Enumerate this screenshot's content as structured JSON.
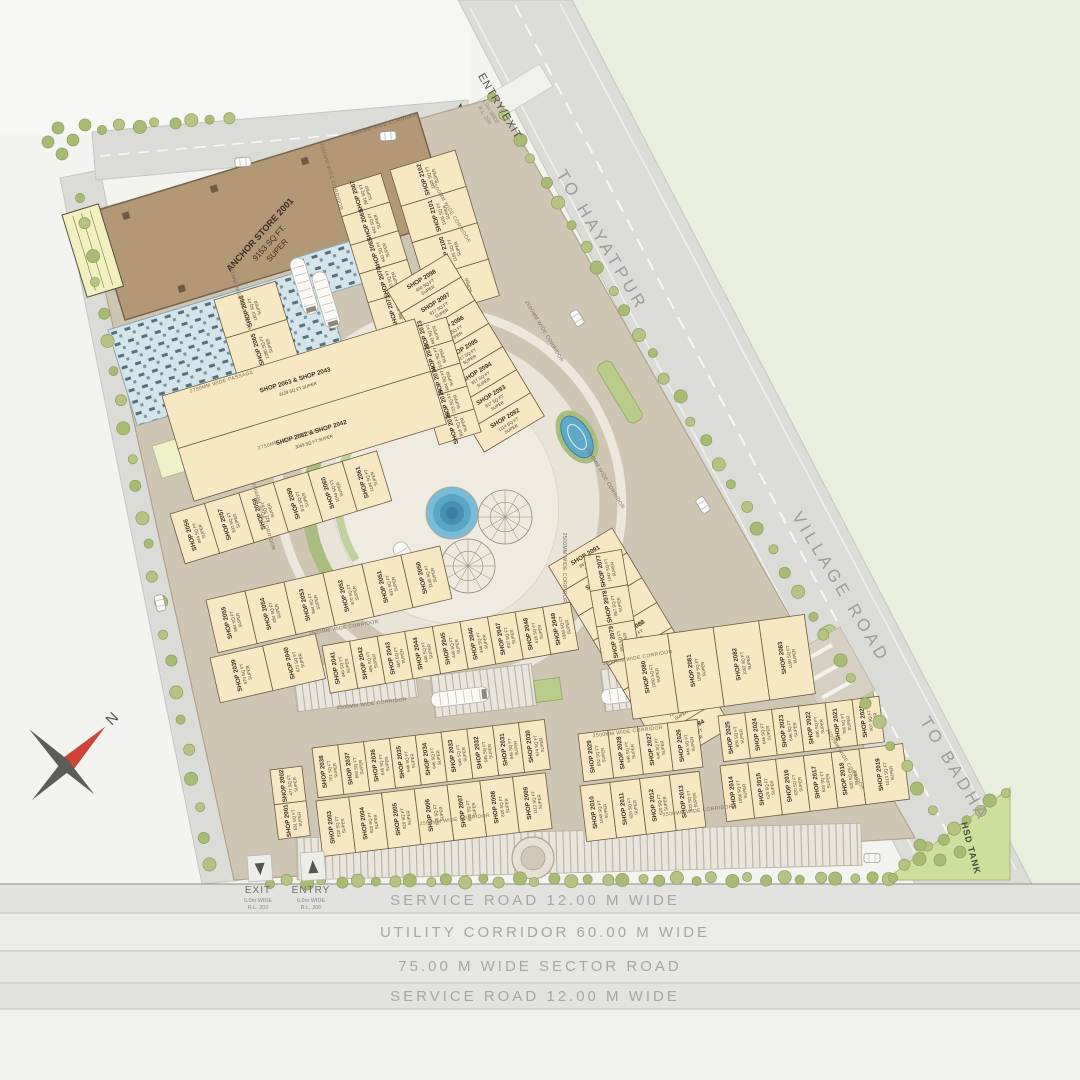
{
  "plan": {
    "compass_label": "N",
    "roads": {
      "to_hayatpur": "TO HAYATPUR",
      "village_road": "VILLAGE ROAD",
      "to_badha": "TO BADHA"
    },
    "bands": {
      "service_top": "SERVICE ROAD 12.00 M WIDE",
      "utility": "UTILITY CORRIDOR 60.00 M WIDE",
      "sector": "75.00 M WIDE  SECTOR ROAD",
      "service_bottom": "SERVICE ROAD 12.00 M WIDE"
    },
    "gates": {
      "entry_exit": "ENTRY/EXIT",
      "exit": "EXIT",
      "entry": "ENTRY",
      "width_note": "6.0m WIDE",
      "rl_note": "R.L. 200"
    },
    "anchor": {
      "line1": "ANCHOR STORE 2001",
      "line2": "9153 SQ FT.",
      "line3": "SUPER"
    },
    "hsd_tank": "HSD TANK",
    "lift_label": "H",
    "words": {
      "shop": "SHOP",
      "sqft": "SQ FT",
      "super": "SUPER"
    },
    "corridor_label": "2500MM WIDE CORRIDOR",
    "passage_label": "2750MM WIDE PASSAGE",
    "colors": {
      "shop_fill": "#f7e7c2",
      "anchor_fill": "#b39878",
      "road_fill": "#dbdbd7",
      "site_fill": "#cfc5b3",
      "green_area": "#eaeedd",
      "water": "#5fa8c8",
      "lawn": "#b9cc8b",
      "hsd_fill": "#cede9c"
    },
    "corridor_positions": [
      [
        385,
        126,
        -17,
        "c"
      ],
      [
        330,
        177,
        73,
        "c"
      ],
      [
        450,
        213,
        59,
        "c"
      ],
      [
        543,
        332,
        59,
        "c"
      ],
      [
        238,
        297,
        73,
        "c"
      ],
      [
        222,
        383,
        -17,
        "p"
      ],
      [
        262,
        517,
        73,
        "c"
      ],
      [
        344,
        629,
        -10,
        "c"
      ],
      [
        372,
        705,
        -7,
        "c"
      ],
      [
        563,
        568,
        90,
        "c"
      ],
      [
        604,
        479,
        59,
        "c"
      ],
      [
        638,
        659,
        -10,
        "c"
      ],
      [
        628,
        733,
        -7,
        "c"
      ],
      [
        455,
        821,
        -7,
        "c"
      ],
      [
        698,
        812,
        -7,
        "c"
      ],
      [
        844,
        760,
        59,
        "c"
      ],
      [
        290,
        440,
        -17,
        "p"
      ]
    ],
    "blocks": [
      {
        "id": "col-2066",
        "x": 214,
        "y": 300,
        "r": -17,
        "dir": "col",
        "cw": 64,
        "ch": 40,
        "shops": [
          [
            "2066",
            "1657"
          ],
          [
            "2065",
            "1280"
          ],
          [
            "2064",
            "1175"
          ]
        ]
      },
      {
        "id": "col-2067",
        "x": 333,
        "y": 188,
        "r": -17,
        "dir": "col",
        "cw": 50,
        "ch": 30,
        "shops": [
          [
            "2067",
            "881"
          ],
          [
            "2068",
            "642"
          ],
          [
            "2069",
            "643"
          ],
          [
            "2070",
            "643"
          ],
          [
            "2071",
            "886"
          ]
        ]
      },
      {
        "id": "col-2102",
        "x": 390,
        "y": 170,
        "r": -17,
        "dir": "col",
        "cw": 68,
        "ch": 38,
        "shops": [
          [
            "2102",
            "1105"
          ],
          [
            "2101",
            "1105"
          ],
          [
            "2100",
            "1105"
          ],
          [
            "2099",
            "1105"
          ]
        ]
      },
      {
        "id": "strip-2098",
        "x": 447,
        "y": 254,
        "r": 59,
        "dir": "row",
        "cw": 27,
        "ch": 70,
        "shops": [
          [
            "2098",
            "450"
          ],
          [
            "2097",
            "817"
          ],
          [
            "2096",
            "817"
          ],
          [
            "2095",
            "817"
          ],
          [
            "2094",
            "817"
          ],
          [
            "2093",
            "817"
          ],
          [
            "2092",
            "1114"
          ]
        ]
      },
      {
        "id": "col-2073",
        "x": 404,
        "y": 330,
        "r": -17,
        "dir": "col",
        "cw": 44,
        "ch": 24,
        "shops": [
          [
            "2073",
            "492"
          ],
          [
            "2072",
            "575"
          ],
          [
            "2074",
            "804"
          ],
          [
            "2075",
            "723"
          ],
          [
            "2076",
            "918"
          ]
        ]
      },
      {
        "id": "big-units",
        "x": 162,
        "y": 396,
        "r": -17,
        "dir": "col",
        "cw": 264,
        "ch": 55,
        "big": true,
        "shops": [
          [
            "SHOP 2063 & SHOP 2043",
            "3129"
          ],
          [
            "SHOP 2062 & SHOP 2042",
            "3049"
          ]
        ]
      },
      {
        "id": "row-2056",
        "x": 170,
        "y": 514,
        "r": -17,
        "dir": "row",
        "cw": 36,
        "ch": 52,
        "shops": [
          [
            "2056",
            "844"
          ],
          [
            "2057",
            "832"
          ],
          [
            "2058",
            "821"
          ],
          [
            "2059",
            "872"
          ],
          [
            "2060",
            "1044"
          ],
          [
            "2061",
            "1184"
          ]
        ]
      },
      {
        "id": "row-2055",
        "x": 206,
        "y": 600,
        "r": -13,
        "dir": "row",
        "cw": 40,
        "ch": 54,
        "shops": [
          [
            "2055",
            "864"
          ],
          [
            "2054",
            "854"
          ],
          [
            "2053",
            "844"
          ],
          [
            "2052",
            "870"
          ],
          [
            "2051",
            "831"
          ],
          [
            "2050",
            "1108"
          ]
        ]
      },
      {
        "id": "row-2039",
        "x": 210,
        "y": 658,
        "r": -13,
        "dir": "row",
        "cw": 54,
        "ch": 46,
        "shops": [
          [
            "2039",
            "970"
          ],
          [
            "2040",
            "870"
          ]
        ]
      },
      {
        "id": "row-2041",
        "x": 322,
        "y": 646,
        "r": -10,
        "dir": "row",
        "cw": 28,
        "ch": 48,
        "shops": [
          [
            "2041",
            "440"
          ],
          [
            "2042",
            "465"
          ],
          [
            "2043",
            "465"
          ],
          [
            "2044",
            "446"
          ],
          [
            "2045",
            "446"
          ],
          [
            "2046",
            "446"
          ],
          [
            "2047",
            "837"
          ],
          [
            "2048",
            "618"
          ],
          [
            "2049",
            "1040"
          ]
        ]
      },
      {
        "id": "strip-2091",
        "x": 612,
        "y": 528,
        "r": 59,
        "dir": "row",
        "cw": 29,
        "ch": 74,
        "shops": [
          [
            "2091",
            "867"
          ],
          [
            "2090",
            "724"
          ],
          [
            "2089",
            "724"
          ],
          [
            "2088",
            "724"
          ],
          [
            "2087",
            "724"
          ],
          [
            "2086",
            "724"
          ],
          [
            "2085",
            "724"
          ],
          [
            "2084",
            "724"
          ]
        ]
      },
      {
        "id": "col-2077",
        "x": 584,
        "y": 556,
        "r": -10,
        "dir": "col",
        "cw": 38,
        "ch": 36,
        "shops": [
          [
            "2077",
            "1047"
          ],
          [
            "2078",
            "867"
          ],
          [
            "2079",
            "853"
          ]
        ]
      },
      {
        "id": "row-2080",
        "x": 622,
        "y": 640,
        "r": -8,
        "dir": "row",
        "cw": 46,
        "ch": 80,
        "shops": [
          [
            "2080",
            "1050"
          ],
          [
            "2081",
            "1050"
          ],
          [
            "2082",
            "1052"
          ],
          [
            "2083",
            "1190"
          ]
        ]
      },
      {
        "id": "row-2038",
        "x": 312,
        "y": 748,
        "r": -7,
        "dir": "row",
        "cw": 26,
        "ch": 50,
        "shops": [
          [
            "2038",
            "701"
          ],
          [
            "2037",
            "660"
          ],
          [
            "2036",
            "646"
          ],
          [
            "2035",
            "646"
          ],
          [
            "2034",
            "646"
          ],
          [
            "2033",
            "645"
          ],
          [
            "2032",
            "646"
          ],
          [
            "2031",
            "646"
          ],
          [
            "2030",
            "674"
          ]
        ]
      },
      {
        "id": "row-2003",
        "x": 316,
        "y": 801,
        "r": -7,
        "dir": "row",
        "cw": 33,
        "ch": 56,
        "shops": [
          [
            "2003",
            "820"
          ],
          [
            "2004",
            "820"
          ],
          [
            "2005",
            "820"
          ],
          [
            "2006",
            "820"
          ],
          [
            "2007",
            "820"
          ],
          [
            "2008",
            "820"
          ],
          [
            "2009",
            "1112"
          ]
        ]
      },
      {
        "id": "col-2002",
        "x": 270,
        "y": 770,
        "r": -7,
        "dir": "col",
        "cw": 32,
        "ch": 35,
        "shops": [
          [
            "2002",
            "477"
          ],
          [
            "2001",
            "531"
          ]
        ]
      },
      {
        "id": "row-2029",
        "x": 578,
        "y": 734,
        "r": -7,
        "dir": "row",
        "cw": 30,
        "ch": 48,
        "shops": [
          [
            "2029",
            "832"
          ],
          [
            "2028",
            "646"
          ],
          [
            "2027",
            "646"
          ],
          [
            "2026",
            "646"
          ]
        ]
      },
      {
        "id": "row-2010",
        "x": 580,
        "y": 786,
        "r": -7,
        "dir": "row",
        "cw": 30,
        "ch": 56,
        "shops": [
          [
            "2010",
            "1045"
          ],
          [
            "2011",
            "620"
          ],
          [
            "2012",
            "620"
          ],
          [
            "2013",
            "620"
          ]
        ]
      },
      {
        "id": "row-2025",
        "x": 718,
        "y": 716,
        "r": -7,
        "dir": "row",
        "cw": 27,
        "ch": 46,
        "shops": [
          [
            "2025",
            "856"
          ],
          [
            "2024",
            "646"
          ],
          [
            "2023",
            "646"
          ],
          [
            "2022",
            "646"
          ],
          [
            "2021",
            "766"
          ],
          [
            "2020",
            "507"
          ]
        ]
      },
      {
        "id": "row-2014",
        "x": 720,
        "y": 766,
        "r": -7,
        "dir": "row",
        "cw": 28,
        "ch": 56,
        "shops": [
          [
            "2014",
            "1066"
          ],
          [
            "2015",
            "620"
          ],
          [
            "2016",
            "620"
          ],
          [
            "2017",
            "620"
          ],
          [
            "2018",
            "620"
          ],
          [
            "2019",
            "1513",
            44
          ]
        ]
      }
    ]
  }
}
